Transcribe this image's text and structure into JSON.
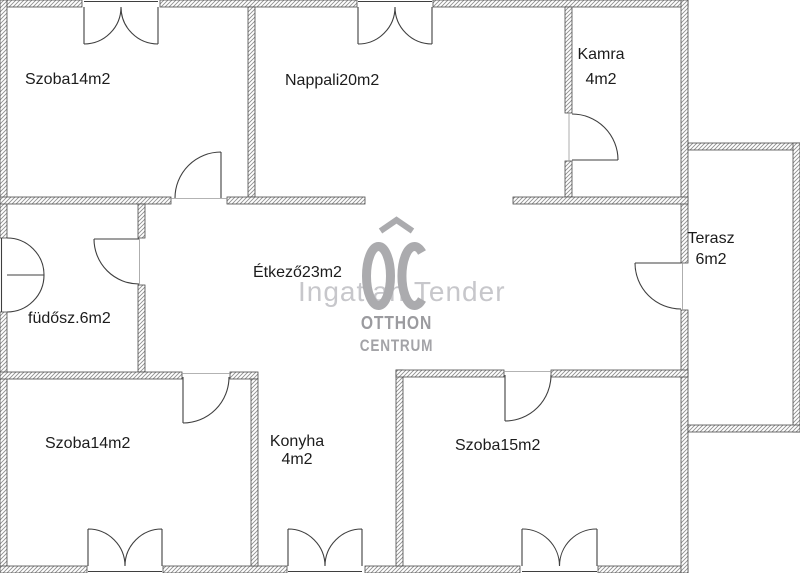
{
  "rooms": [
    {
      "id": "szoba_top_left",
      "label": "Szoba14m2"
    },
    {
      "id": "nappali",
      "label": "Nappali20m2"
    },
    {
      "id": "kamra",
      "label": "Kamra",
      "area": "4m2"
    },
    {
      "id": "terasz",
      "label": "Terasz",
      "area": "6m2"
    },
    {
      "id": "etkezo",
      "label": "Étkező23m2"
    },
    {
      "id": "furdoszoba",
      "label": "füdősz.6m2"
    },
    {
      "id": "szoba_bottom_left",
      "label": "Szoba14m2"
    },
    {
      "id": "konyha",
      "label": "Konyha",
      "area": "4m2"
    },
    {
      "id": "szoba_bottom_right",
      "label": "Szoba15m2"
    }
  ],
  "watermark": {
    "logo_text": "OC",
    "brand_line": "Ingatlan Tender",
    "logo_sub1": "OTTHON",
    "logo_sub2": "CENTRUM"
  },
  "colors": {
    "background": "#ffffff",
    "wall_outline": "#4a4a4a",
    "wall_hatch": "#8f8f8f",
    "door_line": "#3f3f3f",
    "label_text": "#1c1c1c",
    "watermark_logo": "#ababae",
    "watermark_brand_text": "#c7c7cb",
    "watermark_logo_text": "#9b9b9f"
  }
}
